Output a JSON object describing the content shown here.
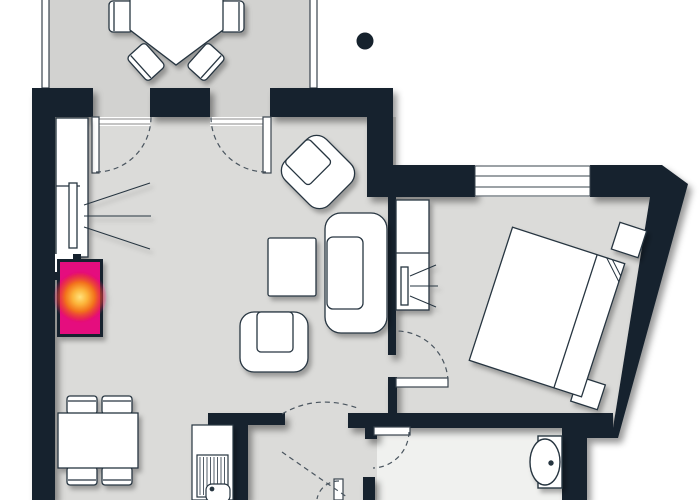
{
  "plan": {
    "kind": "apartment-floor-plan",
    "colors": {
      "background": "#ffffff",
      "wall": "#16222d",
      "outline": "#283541",
      "floor": "#dbdbd9",
      "balcony_floor": "#d2d2d0",
      "bathroom_floor": "#f0f1ef",
      "furniture": "#ffffff",
      "highlight": "#e5087e",
      "glow_core": "#ffe27c",
      "glow_mid": "#f2711c",
      "threshold_line": "#8a8a88",
      "swing_line": "#4a555f"
    },
    "rooms": [
      {
        "name": "balcony"
      },
      {
        "name": "living-room"
      },
      {
        "name": "bedroom"
      },
      {
        "name": "kitchen"
      },
      {
        "name": "hallway"
      },
      {
        "name": "bathroom"
      }
    ],
    "furniture_inventory": [
      {
        "item": "balcony-table",
        "count": 1
      },
      {
        "item": "balcony-chair",
        "count": 4
      },
      {
        "item": "wardrobe-with-rail",
        "count": 2
      },
      {
        "item": "fireplace-highlighted",
        "count": 1
      },
      {
        "item": "armchair",
        "count": 2
      },
      {
        "item": "sofa",
        "count": 1
      },
      {
        "item": "coffee-table",
        "count": 1
      },
      {
        "item": "dining-table",
        "count": 1
      },
      {
        "item": "dining-chair",
        "count": 4
      },
      {
        "item": "kitchen-unit-with-sink",
        "count": 1
      },
      {
        "item": "double-bed",
        "count": 1
      },
      {
        "item": "nightstand",
        "count": 2
      },
      {
        "item": "bathroom-sink",
        "count": 1
      }
    ],
    "marker": {
      "name": "location-dot",
      "color": "#16222d"
    }
  }
}
